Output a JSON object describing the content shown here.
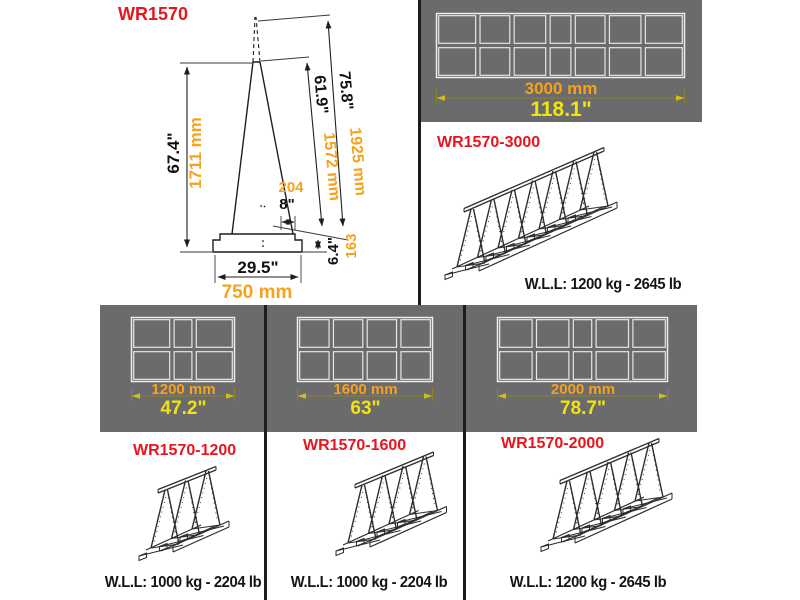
{
  "colors": {
    "panel_gray": "#6b6a6c",
    "accent_orange": "#f6a21c",
    "accent_yellow": "#f2e50d",
    "accent_red": "#e8151e",
    "drawing_line": "#1f1f1f",
    "dim_line_olive": "#8e8324"
  },
  "profile": {
    "model": "WR1570",
    "dims": {
      "height_in": "67.4\"",
      "height_mm": "1711 mm",
      "slope_inner_in": "61.9\"",
      "slope_inner_mm": "1572 mm",
      "slope_outer_in": "75.8\"",
      "slope_outer_mm": "1925 mm",
      "top_width_mm": "204",
      "top_width_in": "8\"",
      "base_height_in": "6.4\"",
      "base_height_mm": "163",
      "base_width_in": "29.5\"",
      "base_width_mm": "750 mm"
    }
  },
  "products": [
    {
      "model": "WR1570-3000",
      "length_mm": "3000 mm",
      "length_in": "118.1\"",
      "wll": "W.L.L: 1200 kg - 2645 lb",
      "uprights": 7,
      "topview_cols": 7,
      "topview_rows": 2
    },
    {
      "model": "WR1570-1200",
      "length_mm": "1200 mm",
      "length_in": "47.2\"",
      "wll": "W.L.L: 1000 kg - 2204 lb",
      "uprights": 3,
      "topview_cols": 3,
      "topview_rows": 2
    },
    {
      "model": "WR1570-1600",
      "length_mm": "1600 mm",
      "length_in": "63\"",
      "wll": "W.L.L: 1000 kg - 2204 lb",
      "uprights": 4,
      "topview_cols": 4,
      "topview_rows": 2
    },
    {
      "model": "WR1570-2000",
      "length_mm": "2000 mm",
      "length_in": "78.7\"",
      "wll": "W.L.L: 1200 kg - 2645 lb",
      "uprights": 5,
      "topview_cols": 5,
      "topview_rows": 2
    }
  ]
}
